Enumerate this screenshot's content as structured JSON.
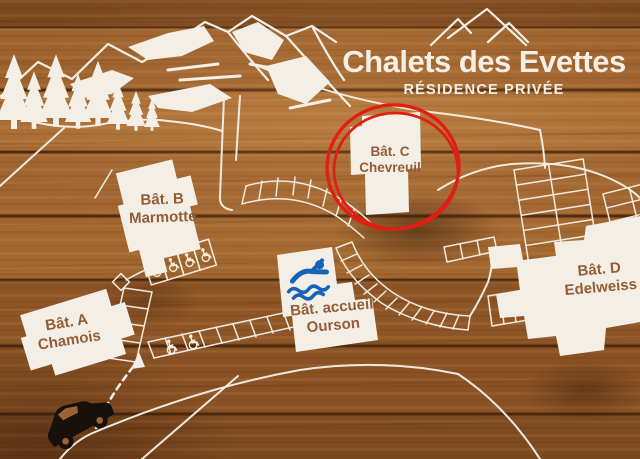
{
  "sign": {
    "title": "Chalets des Evettes",
    "subtitle": "RÉSIDENCE PRIVÉE"
  },
  "buildings": [
    {
      "name": "Bât. A",
      "subtitle": "Chamois"
    },
    {
      "name": "Bât. B",
      "subtitle": "Marmotte"
    },
    {
      "name": "Bât. C",
      "subtitle": "Chevreuil",
      "highlighted": true
    },
    {
      "name": "Bât. accueil",
      "subtitle": "Ourson"
    },
    {
      "name": "Bât. D",
      "subtitle": "Edelweiss"
    }
  ],
  "icons": {
    "pool": "swimmer-icon",
    "car": "car-icon",
    "accessible_parking": "wheelchair-icon",
    "mountains_logo": "mountain-peaks-icon",
    "trees": "pine-tree-icon",
    "direction": "dashed-arrow-icon"
  },
  "colors": {
    "wood_base": "#965c2a",
    "white": "#f4efe6",
    "label_text": "#935c35",
    "highlight_red": "#e01f13",
    "pool_blue": "#1563b8",
    "car_black": "#17100b"
  }
}
